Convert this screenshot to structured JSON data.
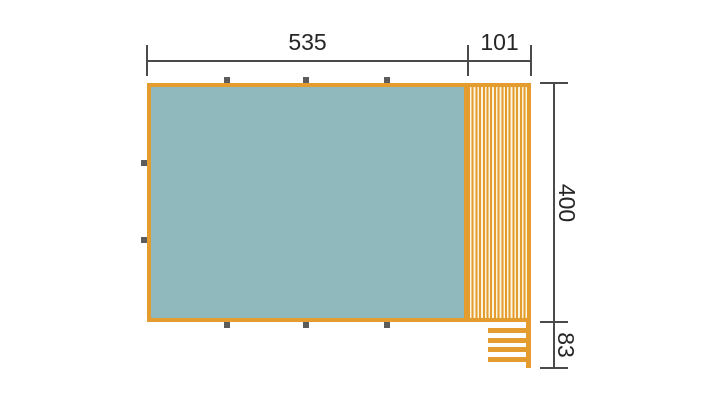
{
  "diagram_type": "floor-plan-top-view",
  "colors": {
    "orange": "#E59C2F",
    "room": "#90B9BD",
    "deck_bg": "#FBF4DE",
    "marker": "#5C5C5C",
    "dim": "#4A4A4A",
    "text": "#262626",
    "background": "#FFFFFF"
  },
  "dimensions": {
    "room_width": "535",
    "deck_width": "101",
    "height": "400",
    "steps_depth": "83"
  },
  "markers": {
    "top_count": 3,
    "bottom_count": 3,
    "left_count": 2
  },
  "steps": {
    "tread_count": 4
  }
}
